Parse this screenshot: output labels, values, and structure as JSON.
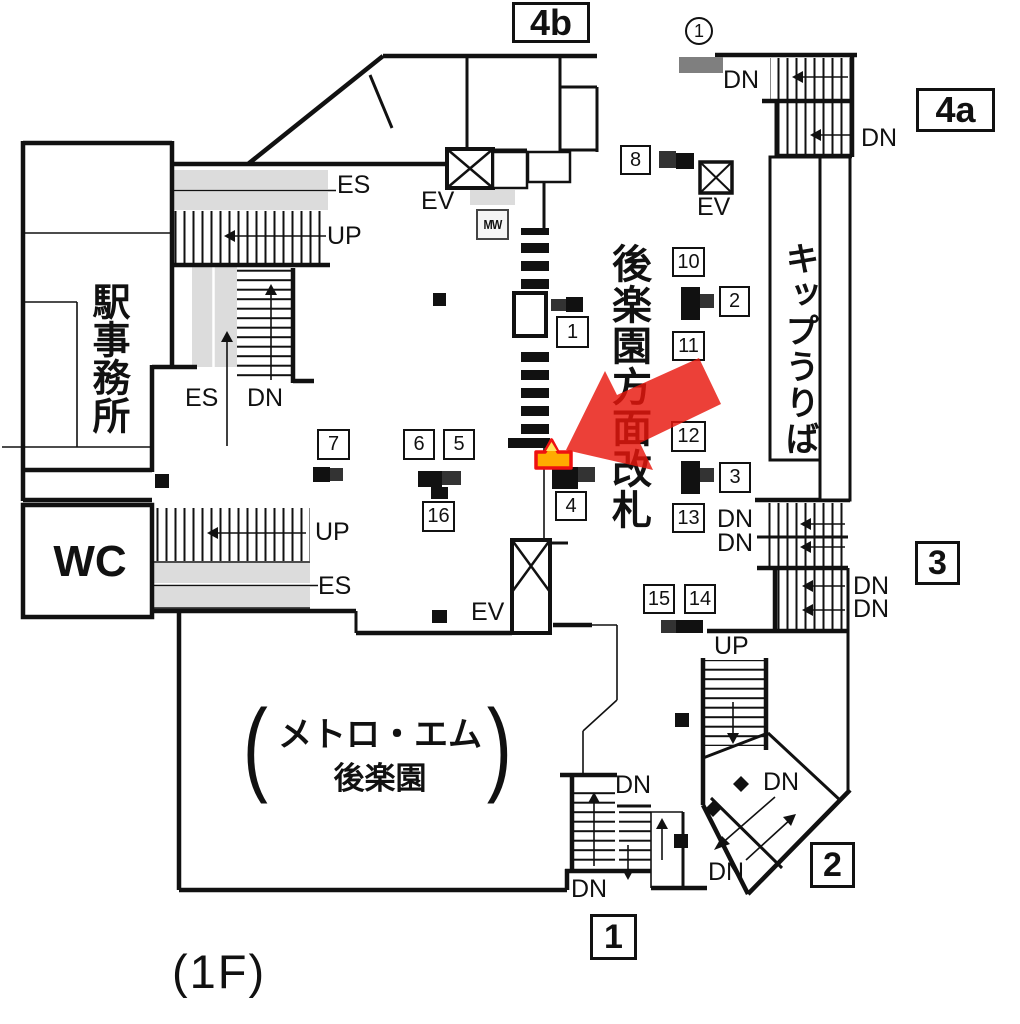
{
  "colors": {
    "line": "#111111",
    "accent_red": "#e8160c",
    "marker_orange": "#ffac00",
    "marker_yellow": "#ffe35c",
    "marker_border": "#ee1111",
    "gray_band": "#dcdcdc",
    "gray_block": "#7f7f7f"
  },
  "floor_label": "(1F)",
  "exits": {
    "e4b": "4b",
    "e4a": "4a",
    "e3": "3",
    "e2": "2",
    "e1": "1"
  },
  "circled": {
    "one": "1"
  },
  "rooms": {
    "station_office": "駅事務所",
    "wc": "WC",
    "metro_line1": "メトロ・エム",
    "metro_line2": "後楽園",
    "paren_open": "(",
    "paren_close": ")"
  },
  "areas": {
    "gate_vertical": "後楽園方面改札",
    "ticket_vertical": "キップうりば"
  },
  "labels": {
    "up": "UP",
    "dn": "DN",
    "es": "ES",
    "ev": "EV",
    "mw": "MW"
  },
  "signs": {
    "s1": "1",
    "s2": "2",
    "s3": "3",
    "s4": "4",
    "s5": "5",
    "s6": "6",
    "s7": "7",
    "s8": "8",
    "s10": "10",
    "s11": "11",
    "s12": "12",
    "s13": "13",
    "s14": "14",
    "s15": "15",
    "s16": "16"
  }
}
